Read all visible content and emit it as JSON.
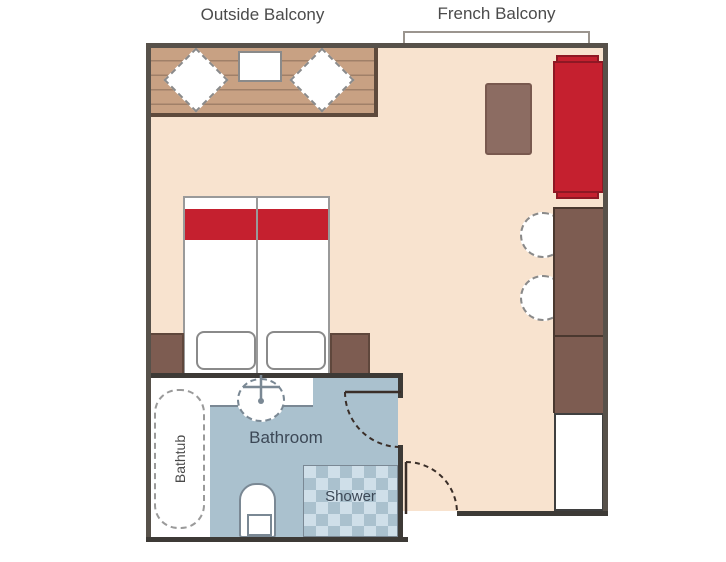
{
  "labels": {
    "outside_balcony": "Outside Balcony",
    "french_balcony": "French Balcony",
    "bathroom": "Bathroom",
    "bathtub": "Bathtub",
    "shower": "Shower"
  },
  "colors": {
    "floor": "#f8e3cf",
    "deck_wood": "#c8a183",
    "deck_border": "#5e4a3c",
    "wall": "#57514a",
    "bathroom_wall": "#3d3a36",
    "accent_red": "#c5202f",
    "accent_red_dark": "#8e1824",
    "wood_brown": "#7d5c51",
    "wood_brown_dark": "#4a382f",
    "dresser_brown": "#8c6c62",
    "bathroom_floor": "#aac1ce",
    "checker_light": "#cfdfe9",
    "fixture_outline": "#7a8894",
    "furniture_outline": "#8a8a8a",
    "label_color": "#4b4b4b",
    "bathroom_label_color": "#3c4856"
  },
  "inventory": {
    "balcony_furniture": [
      "deck-chair",
      "balcony-table",
      "deck-chair"
    ],
    "cabin_furniture": [
      "double-bed-with-red-runner",
      "nightstand",
      "nightstand",
      "side-table",
      "red-sofa",
      "round-chair",
      "round-chair",
      "desk-counter",
      "closet"
    ],
    "bathroom_fixtures": [
      "bathtub",
      "sink",
      "toilet",
      "shower"
    ],
    "doors": [
      "bathroom-door",
      "cabin-entry-door"
    ]
  }
}
